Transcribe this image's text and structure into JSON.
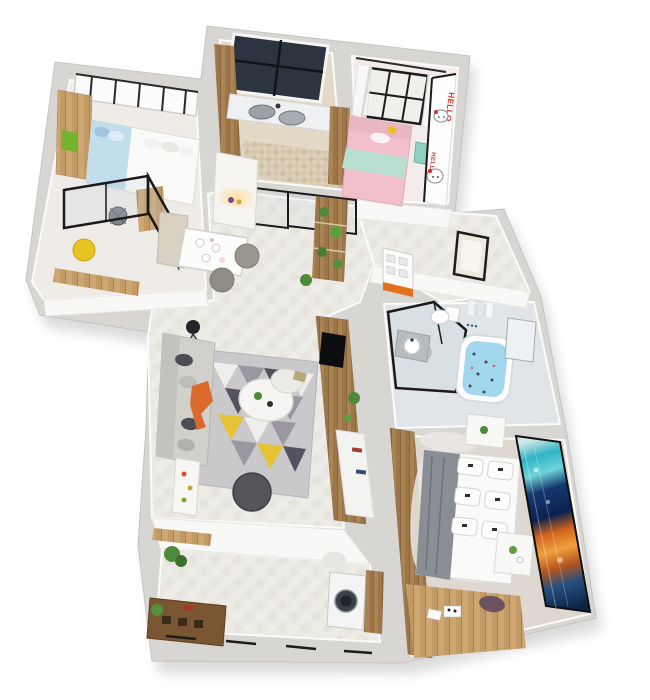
{
  "scene": {
    "type": "isometric-3d-apartment-floor-plan-render",
    "rooms": [
      {
        "id": "study-bedroom",
        "furniture": [
          "single-bed",
          "glass-partition",
          "wardrobe",
          "desk-chair",
          "yellow-pouf",
          "window-band"
        ]
      },
      {
        "id": "kitchen",
        "furniture": [
          "dark-window",
          "double-sink",
          "wood-cabinets",
          "mosaic-floor",
          "glass-slider-door"
        ]
      },
      {
        "id": "kids-bedroom",
        "furniture": [
          "pink-bed",
          "mint-blanket",
          "curtained-window",
          "hello-kitty-wall",
          "teal-cabinet"
        ]
      },
      {
        "id": "entry-hall",
        "furniture": [
          "entry-door-orange-panel",
          "small-window",
          "shoe-cabinet"
        ]
      },
      {
        "id": "dining-area",
        "furniture": [
          "dining-table",
          "two-chairs",
          "bench",
          "ladder-shelf-plants"
        ]
      },
      {
        "id": "living-room",
        "furniture": [
          "sofa",
          "geometric-rug",
          "coffee-tables",
          "pouf",
          "floor-lamp",
          "tv-wood-wall"
        ]
      },
      {
        "id": "bathroom",
        "furniture": [
          "glass-shower",
          "toilet",
          "round-sink",
          "bathtub-with-petals",
          "towels"
        ]
      },
      {
        "id": "master-bedroom",
        "furniture": [
          "double-bed",
          "six-pillows",
          "gray-blanket",
          "nightstands",
          "ocean-mural-wall",
          "wood-wardrobe",
          "window-desk"
        ]
      },
      {
        "id": "balcony-laundry",
        "furniture": [
          "washing-machine",
          "wood-crate",
          "plants",
          "window-rail"
        ]
      }
    ]
  },
  "decals": {
    "hello_kitty_text": "HELLO"
  },
  "colors": {
    "wall": "#d8d6d3",
    "floor_main": "#edebe6",
    "floor_kitchen": "#e3d9c6",
    "floor_bath": "#e2e5e7",
    "floor_bedroom": "#ded8d0",
    "floor_kids": "#f3eceb",
    "floor_study": "#efece7",
    "wood_light": "#c9a877",
    "wood_mid": "#a98456",
    "glass_frame": "#1a1a1a",
    "sofa": "#d2d0cb",
    "pillow_dark": "#4d4c52",
    "throw_orange": "#d96a2b",
    "rug_base": "#c9c8cb",
    "rug_gray": "#9a97a0",
    "rug_dark": "#56515e",
    "rug_yellow": "#e6c235",
    "rug_light": "#efeeec",
    "pouf_dark": "#55545a",
    "pouf_yellow": "#e8c422",
    "bed_blue": "#c2ddec",
    "bed_pink": "#f1c0ca",
    "blanket_mint": "#b9dfd0",
    "blanket_gray": "#898d94",
    "kitty_red": "#d5322d",
    "accent_orange": "#e4701e",
    "window_dark": "#2c3440",
    "tub_water": "#a2d7ee",
    "washer_door": "#3b3f46",
    "crate_brown": "#7a5633",
    "plant_green": "#4f8a3c"
  }
}
